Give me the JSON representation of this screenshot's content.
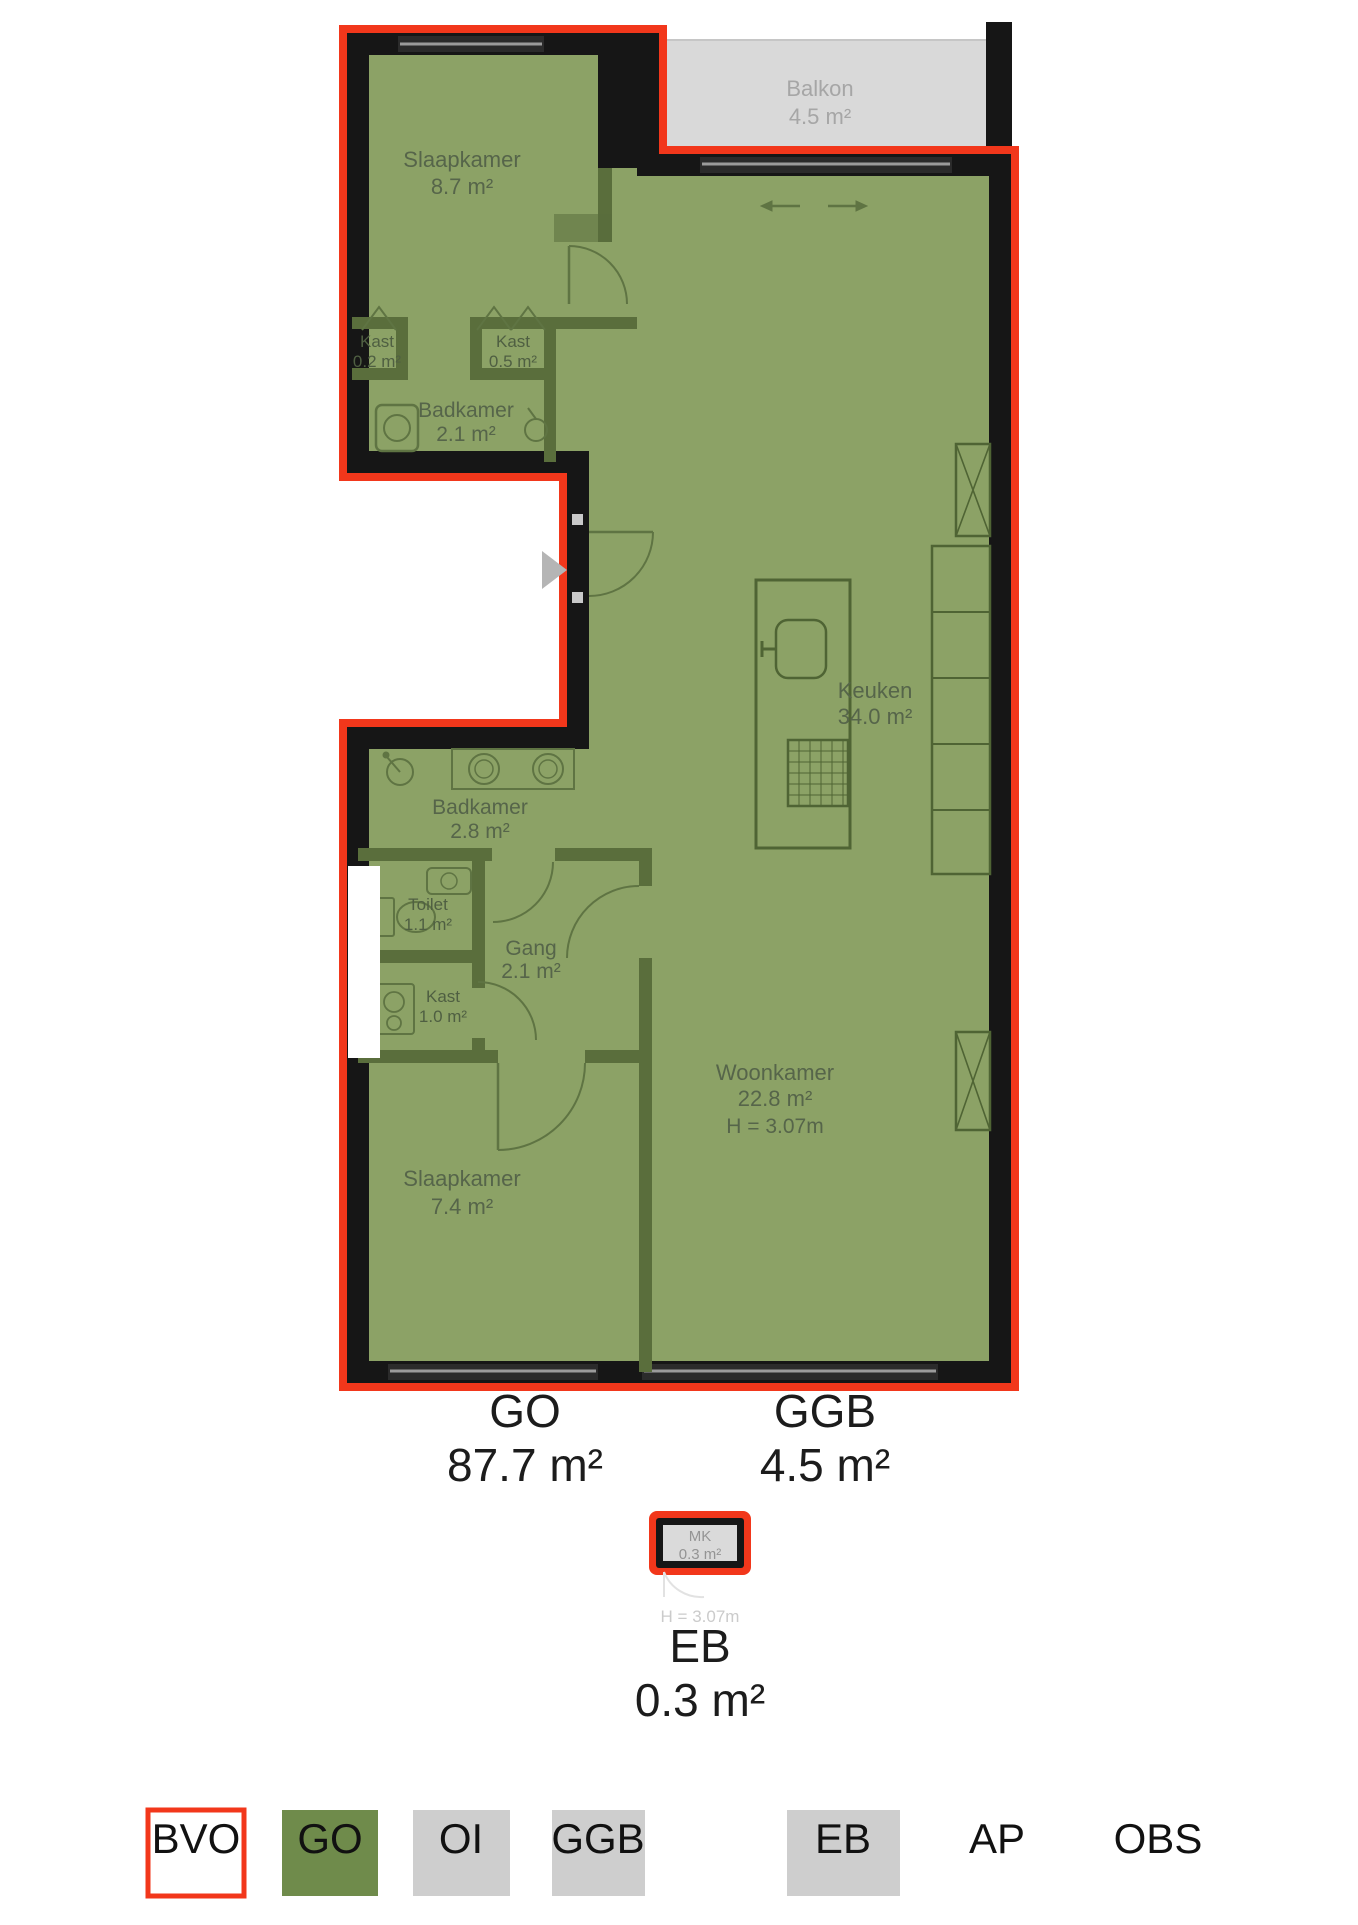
{
  "plan": {
    "balkon": {
      "name": "Balkon",
      "area": "4.5 m²"
    },
    "slaapkamer1": {
      "name": "Slaapkamer",
      "area": "8.7 m²"
    },
    "kast1": {
      "name": "Kast",
      "area": "0.2 m²"
    },
    "kast2": {
      "name": "Kast",
      "area": "0.5 m²"
    },
    "badkamer1": {
      "name": "Badkamer",
      "area": "2.1 m²"
    },
    "keuken": {
      "name": "Keuken",
      "area": "34.0 m²"
    },
    "badkamer2": {
      "name": "Badkamer",
      "area": "2.8 m²"
    },
    "toilet": {
      "name": "Toilet",
      "area": "1.1 m²"
    },
    "gang": {
      "name": "Gang",
      "area": "2.1 m²"
    },
    "kast3": {
      "name": "Kast",
      "area": "1.0 m²"
    },
    "woonkamer": {
      "name": "Woonkamer",
      "area": "22.8 m²",
      "ceiling_height": "H = 3.07m"
    },
    "slaapkamer2": {
      "name": "Slaapkamer",
      "area": "7.4 m²"
    },
    "mk": {
      "name": "MK",
      "area": "0.3 m²",
      "ceiling_height": "H = 3.07m"
    }
  },
  "totals": {
    "go": {
      "label": "GO",
      "value": "87.7 m²"
    },
    "ggb": {
      "label": "GGB",
      "value": "4.5 m²"
    },
    "eb": {
      "label": "EB",
      "value": "0.3 m²"
    }
  },
  "legend": {
    "items": [
      {
        "label": "BVO",
        "fill": "#ffffff"
      },
      {
        "label": "GO",
        "fill": "#6f8b4b"
      },
      {
        "label": "OI",
        "fill": "#cecece"
      },
      {
        "label": "GGB",
        "fill": "#cecece"
      },
      {
        "label": "EB",
        "fill": "#cecece"
      },
      {
        "label": "AP",
        "fill": "none"
      },
      {
        "label": "OBS",
        "fill": "none"
      }
    ]
  },
  "colors": {
    "outline": "#f2371b",
    "wall": "#161616",
    "room_fill": "#8ca266",
    "partition": "#5a6e3c",
    "balcony_fill": "#d9d9d9",
    "label": "#56654a",
    "balcony_label": "#a6a6a6"
  }
}
